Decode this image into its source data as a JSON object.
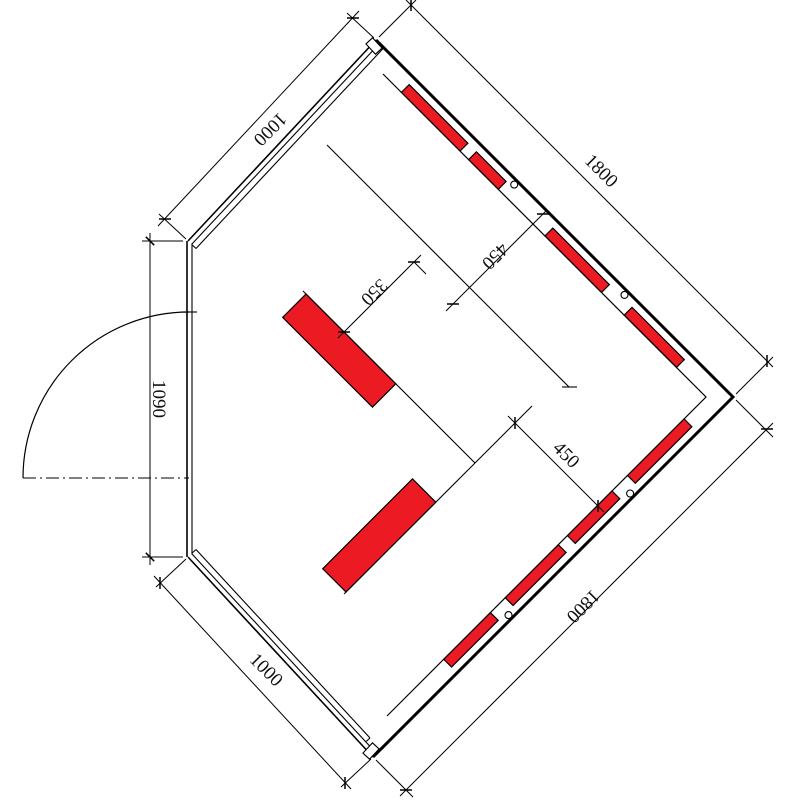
{
  "drawing": {
    "type": "floor-plan",
    "subject": "corner-sauna-top-view"
  },
  "colors": {
    "heater_red": "#ec1b23",
    "line": "#000000",
    "background": "#ffffff"
  },
  "dimensions": {
    "top_right_wall": "1800",
    "bottom_right_wall": "1800",
    "top_left_wall": "1000",
    "bottom_left_wall": "1000",
    "front_wall": "1090",
    "interior_offset_top": "450",
    "interior_offset_bottom": "450",
    "heater_clearance": "350"
  }
}
